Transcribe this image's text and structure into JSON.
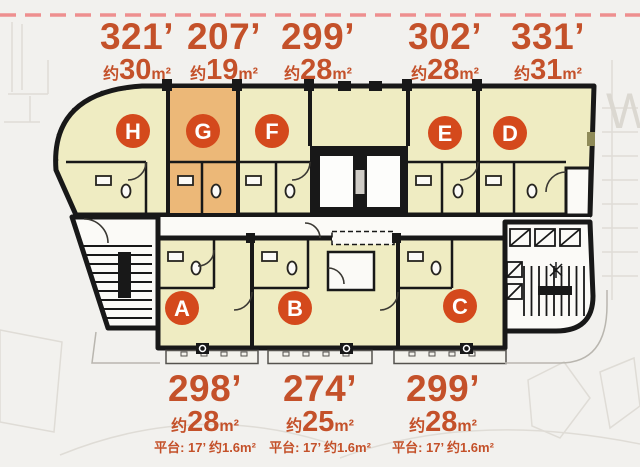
{
  "plan": {
    "watermark": "W",
    "highlighted_unit": "G",
    "units_top": [
      {
        "letter": "H",
        "sqft": "321’",
        "approx": "约",
        "sqm": "30",
        "unit": "m²"
      },
      {
        "letter": "G",
        "sqft": "207’",
        "approx": "约",
        "sqm": "19",
        "unit": "m²"
      },
      {
        "letter": "F",
        "sqft": "299’",
        "approx": "约",
        "sqm": "28",
        "unit": "m²"
      },
      {
        "letter": "E",
        "sqft": "302’",
        "approx": "约",
        "sqm": "28",
        "unit": "m²"
      },
      {
        "letter": "D",
        "sqft": "331’",
        "approx": "约",
        "sqm": "31",
        "unit": "m²"
      }
    ],
    "units_bottom": [
      {
        "letter": "A",
        "sqft": "298’",
        "approx": "约",
        "sqm": "28",
        "unit": "m²",
        "platform": "平台: 17’ 约1.6m²"
      },
      {
        "letter": "B",
        "sqft": "274’",
        "approx": "约",
        "sqm": "25",
        "unit": "m²",
        "platform": "平台: 17’ 约1.6m²"
      },
      {
        "letter": "C",
        "sqft": "299’",
        "approx": "约",
        "sqm": "28",
        "unit": "m²",
        "platform": "平台: 17’ 约1.6m²"
      }
    ]
  },
  "colors": {
    "background": "#f2f1ee",
    "unit_fill": "#efecc2",
    "highlight_fill": "#ecb878",
    "wall": "#181818",
    "badge": "#d4491c",
    "label_text": "#c4512a",
    "boundary_dash": "#ee8f8f",
    "corridor": "#fbfaf7"
  }
}
